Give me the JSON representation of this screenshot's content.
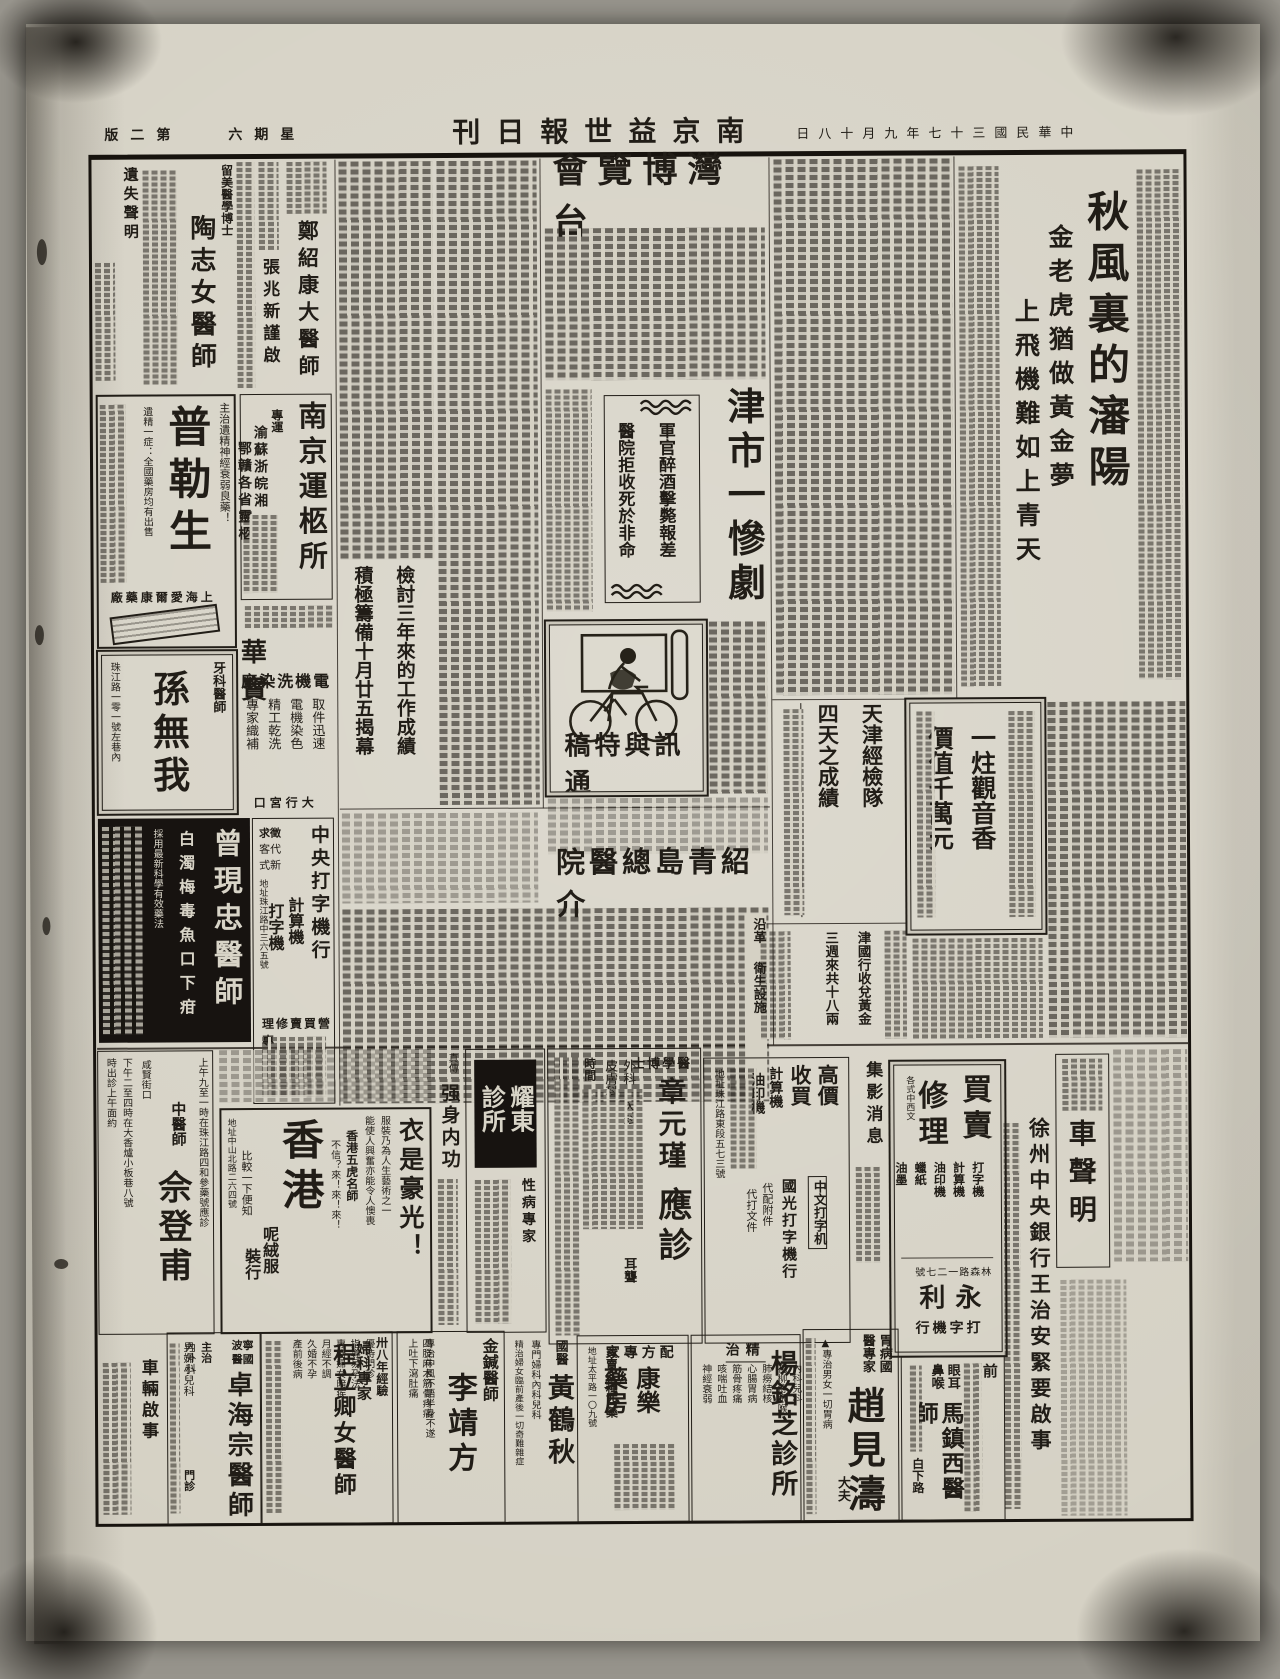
{
  "masthead": {
    "edition": "第二版",
    "weekday": "星期六",
    "title": "南京益世報日刊",
    "date": "中華民國三十七年九月十八日"
  },
  "articles": {
    "shenyang": {
      "title": "秋風裏的瀋陽",
      "sub1": "金老虎猶做黃金夢",
      "sub2": "上飛機難如上青天"
    },
    "taiwan_expo": {
      "title": "台灣博覽會",
      "sub1": "檢討三年來的工作成績",
      "sub2": "積極籌備十月廿五揭幕"
    },
    "tianjin_tragedy": {
      "title": "津市一慘劇",
      "sub1": "軍官醉酒擊斃報差",
      "sub2": "醫院拒收死於非命"
    },
    "jingjian": {
      "line1": "天津經檢隊",
      "line2": "四天之成績"
    },
    "gold": {
      "line1": "津國行收兌黃金",
      "line2": "三週來共十八兩"
    },
    "incense": {
      "line1": "一炷觀音香",
      "line2": "價值千萬元"
    },
    "qingdao": {
      "title": "介紹青島總醫院",
      "sec1": "沿革",
      "sec2": "衛生設施"
    },
    "special_column": {
      "label": "通訊與特稿"
    }
  },
  "ads": {
    "lost_notice": {
      "title": "遺失聲明"
    },
    "tao": {
      "pre": "留美醫學博士",
      "name": "陶志女醫師"
    },
    "zhang_zhao": {
      "name": "張兆新謹啟"
    },
    "zheng": {
      "name": "鄭紹康大醫師"
    },
    "pulesheng": {
      "name": "普勒生",
      "line1": "主治遺精神經衰弱良藥！",
      "line2": "遺精一症：全國藥房均有出售",
      "maker": "上海愛爾康藥廠"
    },
    "coffin": {
      "name": "南京運柩所",
      "pre": "專運",
      "line1": "渝蘇浙皖湘",
      "line2": "鄂贛各省靈柩"
    },
    "sun": {
      "pre": "牙科醫師",
      "name": "孫無我",
      "addr": "珠江路一零一號左巷內"
    },
    "baohua": {
      "name": "寶華",
      "sub": "電機洗染廠",
      "items": [
        "取件迅速",
        "電機染色",
        "精工乾洗",
        "專家織補"
      ],
      "addr": "大行宮口"
    },
    "zeng": {
      "name": "曾現忠醫師",
      "line1": "白濁梅毒魚口下疳",
      "line2": "採用最新科學有效藥法"
    },
    "central_type": {
      "name": "中央打字機行",
      "tags": [
        "徵求",
        "代客",
        "新式"
      ],
      "items": [
        "計算機",
        "打字機"
      ],
      "biz": "專營買賣修理",
      "addr": "地址珠江路中三六五號"
    },
    "she": {
      "pre": "中醫師",
      "name": "佘登甫",
      "sched1": "上午九至一時在珠江路四和參藥號應診",
      "sched2": "咸賢街口",
      "sched3": "下午二至四時在大香爐小板巷八號",
      "sched4": "時出診上午面約"
    },
    "hongkong": {
      "name": "香港",
      "sub1": "呢絨服",
      "sub2": "裝行",
      "slogan": "衣是豪光！",
      "body1": "服裝乃為人生藝術之一",
      "body2": "能使人興奮亦能令人懊喪",
      "line1": "香港五虎名師",
      "line2": "比較一下便知",
      "line3": "不信？來！來！來！",
      "addr": "地址中山北路二六四號"
    },
    "strong": {
      "pre": "真傳",
      "name": "强身内功"
    },
    "yaodong": {
      "name": "耀東診所",
      "sub": "性病專家"
    },
    "zhang_yuanjin": {
      "pre": "醫學博士",
      "name": "章元瑾",
      "name2": "應診",
      "item1": "外科",
      "item2": "內科",
      "item3": "皮膚科",
      "note": "耳聾",
      "time": "時間"
    },
    "guoguang": {
      "title": "高價收買",
      "item1": "計算機",
      "item2": "油印機",
      "sub": "中文打字机",
      "name": "國光打字機行",
      "svc1": "代配附件",
      "svc2": "代打文件",
      "addr": "地址珠江路東段五七三號"
    },
    "jiying": {
      "title": "集影消息"
    },
    "yongli": {
      "t1": "買賣",
      "t2": "修理",
      "small": "各式中西文",
      "items": [
        "打字機",
        "計算機",
        "油印機",
        "蠟紙",
        "油墨"
      ],
      "name": "永利",
      "sub": "打字機行",
      "addr": "林森路一二七號"
    },
    "che_shengming": {
      "title": "車聲明"
    },
    "xuzhou": {
      "title": "徐州中央銀行王治安緊要啟事"
    },
    "ma": {
      "pre1": "前",
      "pre2": "眼耳鼻喉",
      "name": "馬鎮西醫師",
      "addr": "白下路"
    },
    "zhao": {
      "pre": "胃病國醫專家",
      "name": "趙見濤",
      "suf": "大夫",
      "line": "▲專治男女一切胃病"
    },
    "yang": {
      "pre": "精治",
      "name": "楊銘芝診所",
      "items": [
        "內科兒科",
        "花柳痔眼喉",
        "肺癆結核",
        "心腸胃病",
        "筋骨疼痛",
        "咳喘吐血",
        "神經衰弱"
      ]
    },
    "kangle": {
      "pre": "配方專家",
      "name": "康樂藥房",
      "line1": "買賣各種西藥",
      "addr": "地址太平路一〇九號"
    },
    "huang": {
      "pre": "國醫",
      "name": "黃鶴秋",
      "line1": "專門婦科內科兒科",
      "line2": "精治婦女臨前產後一切奇難雜症"
    },
    "li": {
      "pre": "金鍼醫師",
      "name": "李靖方",
      "line1": "專治中風不語半身不遂",
      "line2": "四肢麻木筋骨疼痛",
      "line3": "上吐下瀉肚痛",
      "addr": "地址白下路"
    },
    "cheng": {
      "pre1": "卅八年經驗",
      "pre2": "婦科專家",
      "name": "程立卿女醫師",
      "items": [
        "優待門診",
        "指導易孕法",
        "專治婦女暗疾",
        "月經不調",
        "久婚不孕",
        "產前後病"
      ]
    },
    "zhuo": {
      "pre1": "寧波",
      "pre2": "國醫",
      "name": "卓海宗醫師",
      "line1": "主治",
      "line2": "內外科",
      "line3": "男婦小兒科",
      "line4": "門診"
    },
    "che_qishi": {
      "title": "車輛啟事"
    }
  }
}
